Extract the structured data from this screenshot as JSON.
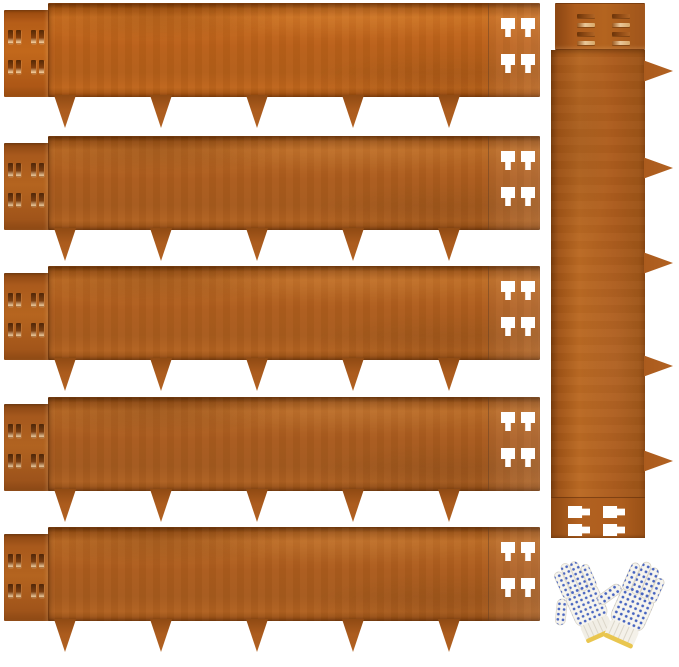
{
  "page": {
    "kind": "product-photo"
  },
  "scene": {
    "subject": "rust-finish steel landscape edging strips with ground stakes, connector slots, keyhole cutouts, and a pair of dotted work gloves",
    "items": {
      "horizontal_strip_count": 5,
      "vertical_strip_count": 1,
      "stakes_per_strip": 5,
      "slot_rows_per_connector": 2,
      "slots_per_row": 4,
      "keyhole_cutouts_per_strip": 4,
      "glove_count": 2
    }
  },
  "colors": {
    "background": "#ffffff",
    "rust_base": "#ab5b1d",
    "rust_light": "#bb6a24",
    "rust_dark": "#8f4a13",
    "rust_deep": "#6e3609",
    "cutout_white": "#ffffff",
    "slot_dark": "#4f2708",
    "slot_highlight": "#e9c79a",
    "glove_fabric": "#f6f4ee",
    "glove_dot_blue": "#3a59bd",
    "glove_cuff_yellow": "#e9c64f"
  }
}
